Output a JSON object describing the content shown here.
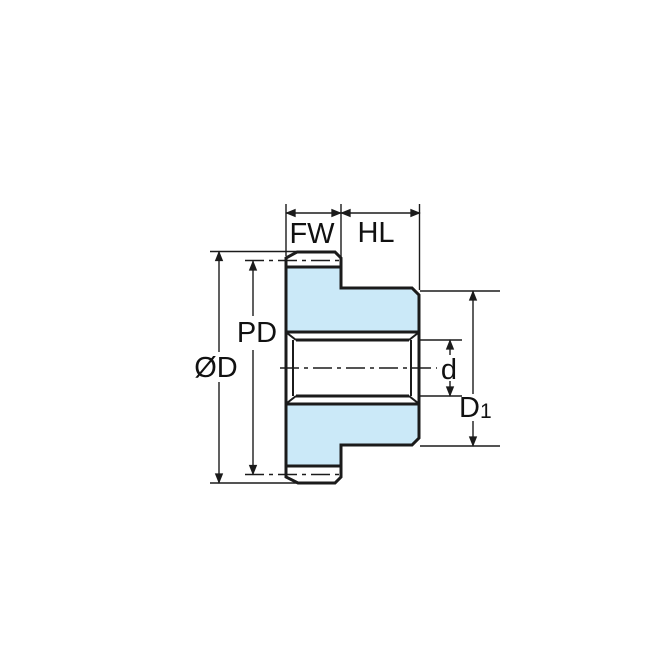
{
  "diagram": {
    "type": "spur-gear-cross-section",
    "labels": {
      "face_width": "FW",
      "hub_length": "HL",
      "pitch_diameter": "PD",
      "outer_diameter": "ØD",
      "bore_diameter": "d",
      "hub_diameter_base": "D",
      "hub_diameter_sub": "1"
    },
    "colors": {
      "body_fill": "#cbe9f8",
      "line": "#1b1b1b",
      "background": "#ffffff"
    }
  }
}
